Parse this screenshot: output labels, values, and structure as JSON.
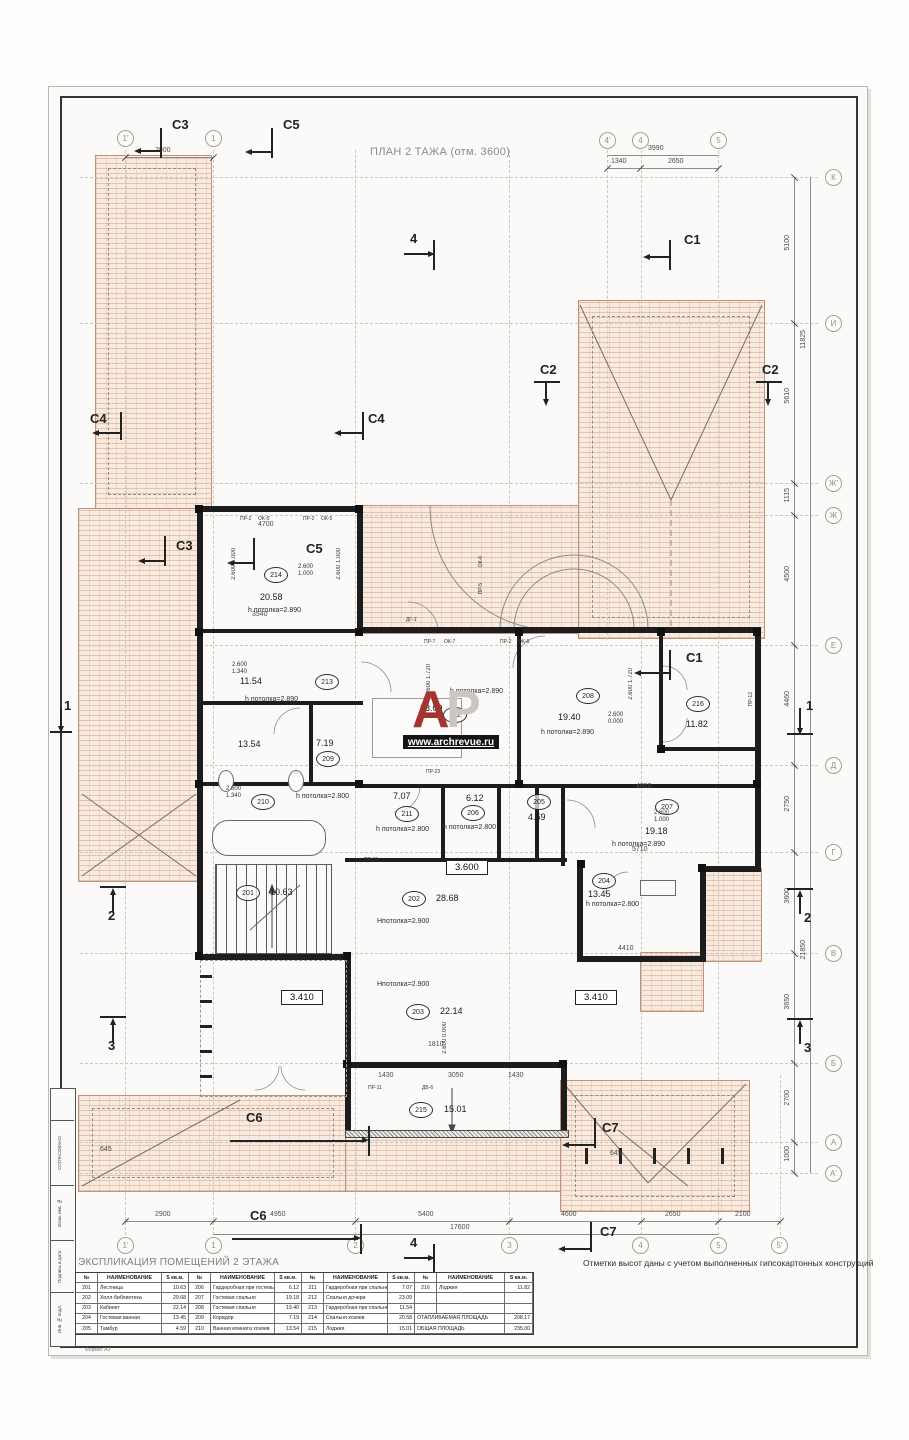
{
  "sheet": {
    "title": "ПЛАН 2 ТАЖА (отм. 3600)",
    "note": "Отметки высот даны с учетом выполненных гипсокартонных конструкций",
    "format_label": "Формат А3"
  },
  "stamp": {
    "labels": [
      "СОГЛАСОВАНО",
      "Взам. инв. №",
      "Подпись и дата",
      "Инв. № подл."
    ]
  },
  "watermark": {
    "logo_a": "А",
    "logo_p": "Р",
    "url": "www.archrevue.ru"
  },
  "grid": {
    "top_left": [
      "1'",
      "1"
    ],
    "top_right": [
      "4'",
      "4",
      "5"
    ],
    "bottom": [
      "1'",
      "1",
      "2",
      "3",
      "4",
      "5",
      "5'"
    ],
    "right": [
      "К",
      "И",
      "Ж'",
      "Ж",
      "Е",
      "Д",
      "Г",
      "В",
      "Б",
      "А",
      "А'"
    ]
  },
  "dims": {
    "top_left": "2900",
    "top_right_total": "3990",
    "top_right": [
      "1340",
      "2650"
    ],
    "bottom": [
      "2900",
      "4950",
      "5400",
      "4600",
      "2650",
      "2100"
    ],
    "bottom_total": "17600",
    "right": [
      "5100",
      "11825",
      "5610",
      "1115",
      "4500",
      "4460",
      "2750",
      "3600",
      "3650",
      "2700",
      "1000"
    ],
    "right_total": "21850",
    "inner": [
      "4700",
      "3540",
      "4850",
      "4410",
      "5710",
      "1430",
      "3050",
      "1430",
      "1810",
      "645",
      "645"
    ]
  },
  "sections": {
    "c1": "С1",
    "c2": "С2",
    "c3": "С3",
    "c4": "С4",
    "c5": "С5",
    "c6": "С6",
    "c7": "С7",
    "n1": "1",
    "n2": "2",
    "n3": "3",
    "n4": "4"
  },
  "levels": {
    "main": "3.600",
    "terrace": "3.410"
  },
  "marks": {
    "v2600": "2.600",
    "v1000": "1.000",
    "v1340": "1.340",
    "v1720": "1.720",
    "v0000": "0.000"
  },
  "wall_tags": [
    "ПР-2",
    "ОК-5'",
    "ПР-2",
    "ОК-5",
    "ПР-5",
    "ОК-6",
    "ПР-7",
    "ОК-7",
    "ПР-2",
    "ОК-6",
    "ПР-15",
    "ПР-23",
    "ПР-11",
    "ДБ-6",
    "ДГ-1'",
    "ПР-12"
  ],
  "rooms": [
    {
      "num": "201",
      "area": "10.63"
    },
    {
      "num": "202",
      "area": "28.68",
      "h": "Нпотолка=2.900"
    },
    {
      "num": "203",
      "area": "22.14",
      "h": "Нпотолка=2.900"
    },
    {
      "num": "204",
      "area": "13.45",
      "h": "h потолка=2.800"
    },
    {
      "num": "205",
      "area": "4.59"
    },
    {
      "num": "206",
      "area": "6.12",
      "h": "h потолка=2.800"
    },
    {
      "num": "207",
      "area": "19.18",
      "h": "h потолка=2.890"
    },
    {
      "num": "208",
      "area": "19.40",
      "h": "h потолка=2.890"
    },
    {
      "num": "209",
      "area": "7.19",
      "h": "h потолка=2.800"
    },
    {
      "num": "210",
      "area": "13.54"
    },
    {
      "num": "211",
      "area": "7.07",
      "h": "h потолка=2.800"
    },
    {
      "num": "212",
      "area": "23.09",
      "h": "h потолка=2.890"
    },
    {
      "num": "213",
      "area": "11.54",
      "h": "h потолка=2.890"
    },
    {
      "num": "214",
      "area": "20.58",
      "h": "h потолка=2.890"
    },
    {
      "num": "215",
      "area": "15.01"
    },
    {
      "num": "216",
      "area": "11.82"
    }
  ],
  "table": {
    "title": "ЭКСПЛИКАЦИЯ ПОМЕЩЕНИЙ 2 ЭТАЖА",
    "headers": [
      "№",
      "НАИМЕНОВАНИЕ",
      "S кв.м."
    ],
    "groups": [
      [
        [
          "201",
          "Лестница",
          "10.63"
        ],
        [
          "202",
          "Холл-библиотека",
          "29.68"
        ],
        [
          "203",
          "Кабинет",
          "22.14"
        ],
        [
          "204",
          "Гостевая ванная",
          "13.45"
        ],
        [
          "205",
          "Тамбур",
          "4.59"
        ]
      ],
      [
        [
          "206",
          "Гардеробная при гостевых",
          "6.12"
        ],
        [
          "207",
          "Гостевая спальня",
          "19.18"
        ],
        [
          "208",
          "Гостевая спальня",
          "19.40"
        ],
        [
          "209",
          "Коридор",
          "7.19"
        ],
        [
          "210",
          "Ванная комната хозяев",
          "13.54"
        ]
      ],
      [
        [
          "211",
          "Гардеробная при спальне",
          "7.07"
        ],
        [
          "212",
          "Спальня дочери",
          "23.09"
        ],
        [
          "213",
          "Гардеробная при спальне",
          "11.54"
        ],
        [
          "214",
          "Спальня хозяев",
          "20.58"
        ],
        [
          "215",
          "Лоджия",
          "15.01"
        ]
      ],
      [
        [
          "216",
          "Лоджия",
          "11.82"
        ],
        [
          "",
          "",
          ""
        ],
        [
          "",
          "",
          ""
        ]
      ]
    ],
    "totals": [
      {
        "label": "ОТАПЛИВАЕМАЯ ПЛОЩАДЬ",
        "value": "208.17"
      },
      {
        "label": "ОБЩАЯ ПЛОЩАДЬ",
        "value": "235.00"
      }
    ]
  }
}
